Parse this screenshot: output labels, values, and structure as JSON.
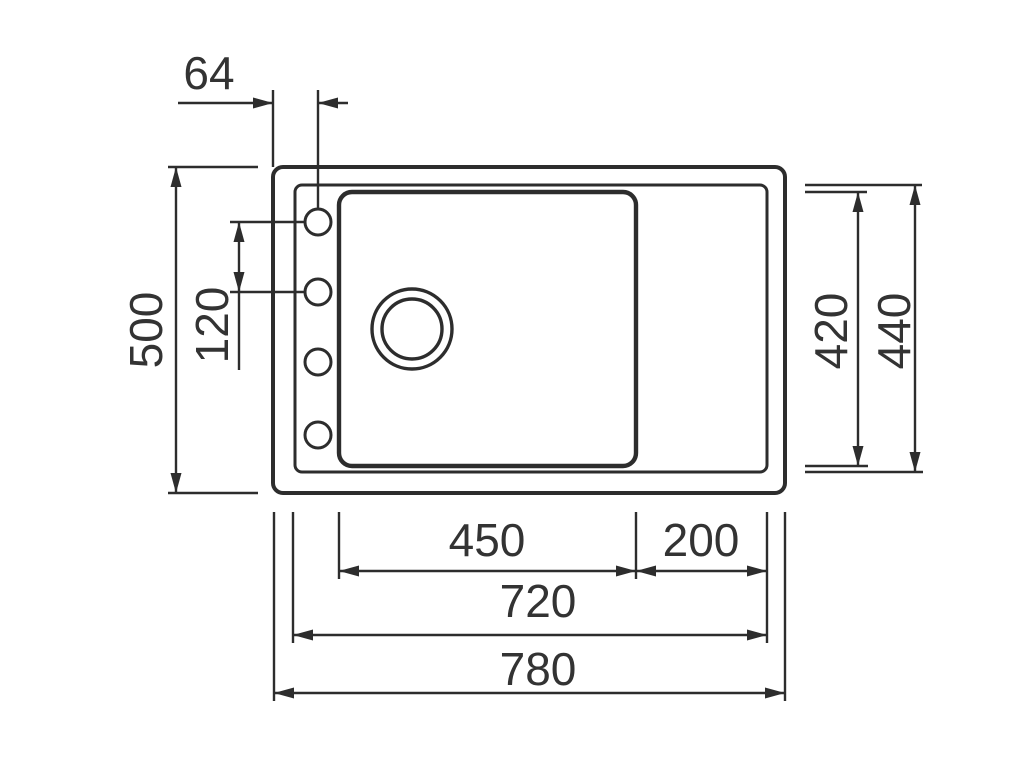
{
  "diagram": {
    "subject": "kitchen-sink-dimension-drawing",
    "view": "top-plan-view",
    "background_color": "#ffffff",
    "line_color": "#2d2d2d",
    "text_color": "#333333",
    "labels": {
      "tap_hole_offset": "64",
      "overall_depth": "500",
      "tap_hole_spacing": "120",
      "bowl_depth": "420",
      "inner_depth": "440",
      "bowl_width": "450",
      "right_ledge_width": "200",
      "inner_width": "720",
      "overall_width": "780"
    },
    "features": {
      "tap_holes": 4,
      "drain_circles": 2
    }
  }
}
